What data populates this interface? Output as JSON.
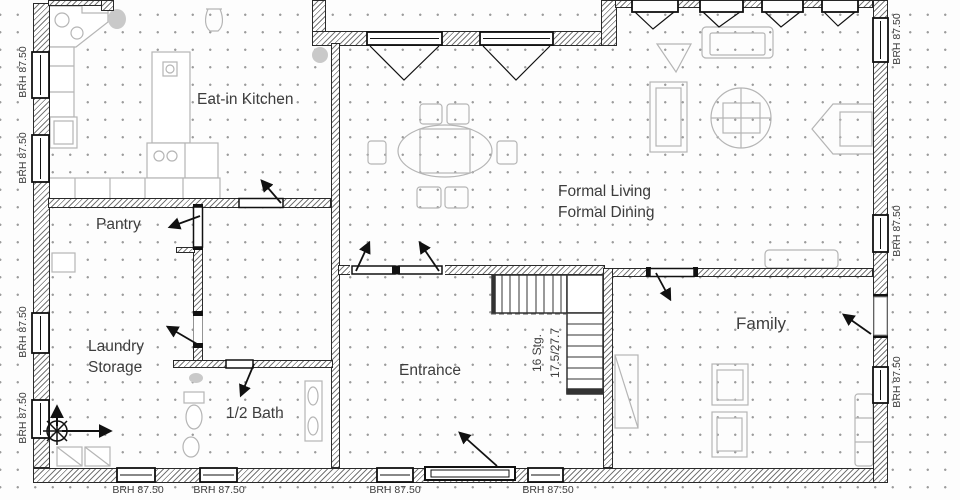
{
  "rooms": {
    "kitchen": "Eat-in Kitchen",
    "pantry": "Pantry",
    "living_line1": "Formal Living",
    "living_line2": "Formal Dining",
    "laundry_line1": "Laundry",
    "laundry_line2": "Storage",
    "bath": "1/2 Bath",
    "entrance": "Entrance",
    "family": "Family"
  },
  "stairs": {
    "line1": "16 Stg.",
    "line2": "17.5/27.7"
  },
  "window_sill_label": "BRH 87.50",
  "colors": {
    "wall_line": "#2a2a2a",
    "wall_hatch": "#5f5f5f",
    "furniture": "#b5b5b5",
    "door_line": "#111111",
    "stair_line": "#333333",
    "text": "#3d3d3d",
    "grid_dot": "#9c9c9c",
    "background": "#fdfdfd"
  }
}
